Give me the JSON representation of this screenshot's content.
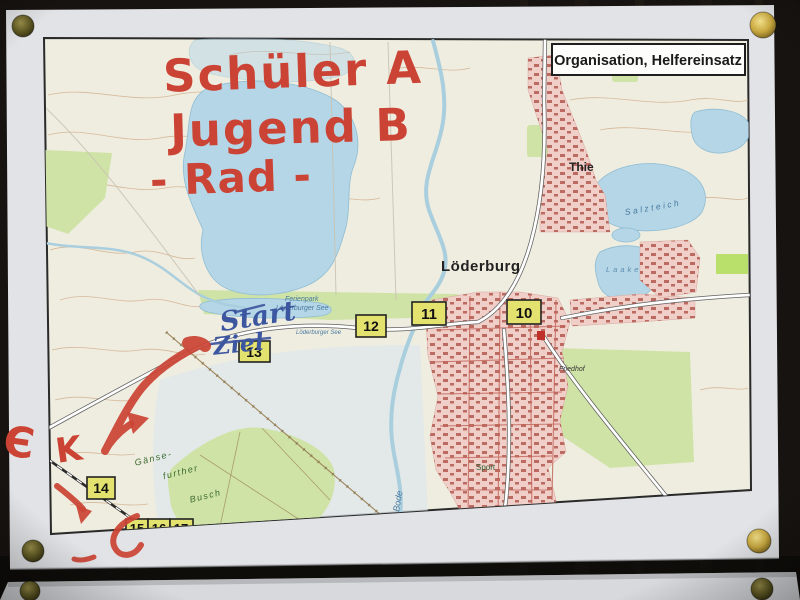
{
  "title_box": {
    "label": "Organisation, Helfereinsatz"
  },
  "marker": {
    "line1": "Schüler A",
    "line2": "Jugend B",
    "line3": "- Rad -",
    "mark_e": "Є",
    "mark_k": "K"
  },
  "pen": {
    "start": "Start",
    "ziel": "Ziel"
  },
  "waypoints": [
    "10",
    "11",
    "12",
    "13",
    "14",
    "15",
    "16",
    "17"
  ],
  "labels": {
    "town": "Löderburg",
    "village": "Thie",
    "lake_ne": "Salzteich",
    "lake_e": "Laake",
    "resort_line1": "Ferienpark",
    "resort_line2": "Löderburger See",
    "lake_shore": "Löderburger See",
    "river": "Bode",
    "sport": "Sport",
    "cemetery": "Friedhof",
    "forest_1": "Gänse-",
    "forest_2": "further",
    "forest_3": "Busch"
  },
  "colors": {
    "marker_red": "#cb4334",
    "pen_blue": "#3d56a0",
    "waypoint_yellow": "#e4e26e",
    "water_blue": "#b5d6e6",
    "forest_green": "#cfe3a6",
    "urban_pink": "#f0cfc9",
    "pin_gold": "#d8b84e"
  }
}
